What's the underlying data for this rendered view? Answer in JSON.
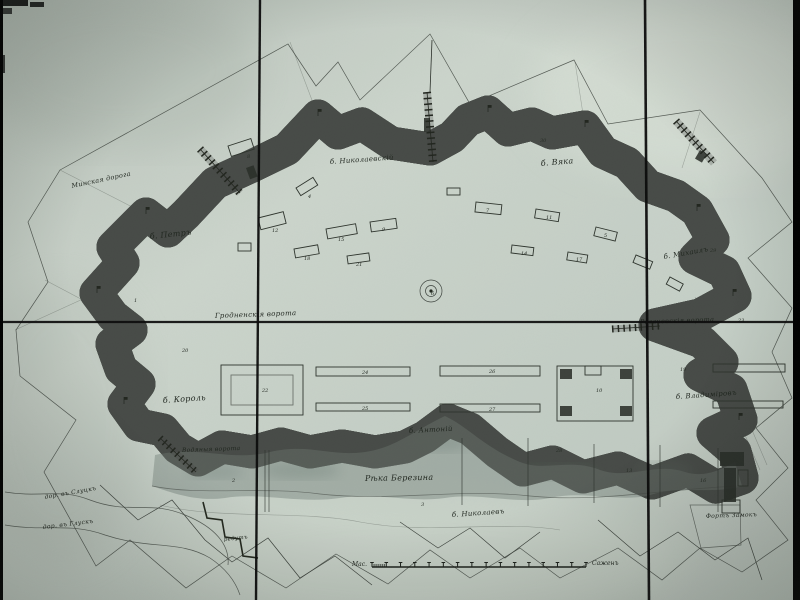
{
  "colors": {
    "paper": "#c6d0c7",
    "paper_light": "#d4dcd2",
    "ink": "#23281f",
    "rampart_dark": "#1e221d",
    "moat_line": "#434843",
    "water": "#94a098",
    "water_deep": "#7c8a83",
    "fold_line": "#0c0c0c",
    "edge_bar": "#000000",
    "label_ink": "#1f251e"
  },
  "plan": {
    "map_labels": [
      {
        "text": "Минская дорога",
        "x": 72,
        "y": 188,
        "rot": -12,
        "size": 6.5
      },
      {
        "text": "б. Петръ",
        "x": 150,
        "y": 239,
        "rot": -6,
        "size": 8
      },
      {
        "text": "б. Николаевскій",
        "x": 330,
        "y": 164,
        "rot": -4,
        "size": 7
      },
      {
        "text": "б. Вяка",
        "x": 541,
        "y": 166,
        "rot": -5,
        "size": 8
      },
      {
        "text": "б. Михаилъ",
        "x": 664,
        "y": 259,
        "rot": -10,
        "size": 7
      },
      {
        "text": "Гродненскія ворота",
        "x": 215,
        "y": 318,
        "rot": -2,
        "size": 7
      },
      {
        "text": "Рогачевскія ворота",
        "x": 640,
        "y": 324,
        "rot": -2,
        "size": 6.5
      },
      {
        "text": "б. Король",
        "x": 163,
        "y": 403,
        "rot": -4,
        "size": 8
      },
      {
        "text": "б. Владиміровъ",
        "x": 676,
        "y": 399,
        "rot": -4,
        "size": 7
      },
      {
        "text": "б. Антоній",
        "x": 409,
        "y": 433,
        "rot": -3,
        "size": 7
      },
      {
        "text": "Рѣка Березина",
        "x": 365,
        "y": 481,
        "rot": -1,
        "size": 8
      },
      {
        "text": "б. Николаевъ",
        "x": 452,
        "y": 517,
        "rot": -4,
        "size": 7
      },
      {
        "text": "Водяныя ворота",
        "x": 182,
        "y": 452,
        "rot": -2,
        "size": 6
      },
      {
        "text": "дор. въ Слуцкъ",
        "x": 45,
        "y": 499,
        "rot": -10,
        "size": 6
      },
      {
        "text": "дор. въ Глускъ",
        "x": 43,
        "y": 529,
        "rot": -7,
        "size": 6
      },
      {
        "text": "Фортъ Замокъ",
        "x": 706,
        "y": 518,
        "rot": -2,
        "size": 6
      },
      {
        "text": "редутъ",
        "x": 224,
        "y": 541,
        "rot": -6,
        "size": 5.5
      }
    ],
    "number_markers": [
      {
        "t": "8",
        "x": 247,
        "y": 158
      },
      {
        "t": "12",
        "x": 272,
        "y": 232
      },
      {
        "t": "4",
        "x": 308,
        "y": 198
      },
      {
        "t": "15",
        "x": 338,
        "y": 241
      },
      {
        "t": "9",
        "x": 382,
        "y": 231
      },
      {
        "t": "18",
        "x": 304,
        "y": 260
      },
      {
        "t": "21",
        "x": 356,
        "y": 266
      },
      {
        "t": "7",
        "x": 486,
        "y": 212
      },
      {
        "t": "11",
        "x": 546,
        "y": 219
      },
      {
        "t": "5",
        "x": 604,
        "y": 237
      },
      {
        "t": "14",
        "x": 521,
        "y": 255
      },
      {
        "t": "17",
        "x": 576,
        "y": 261
      },
      {
        "t": "6",
        "x": 431,
        "y": 295
      },
      {
        "t": "24",
        "x": 362,
        "y": 374
      },
      {
        "t": "26",
        "x": 489,
        "y": 373
      },
      {
        "t": "25",
        "x": 362,
        "y": 410
      },
      {
        "t": "27",
        "x": 489,
        "y": 411
      },
      {
        "t": "22",
        "x": 262,
        "y": 392
      },
      {
        "t": "10",
        "x": 596,
        "y": 392
      },
      {
        "t": "19",
        "x": 680,
        "y": 371
      },
      {
        "t": "2",
        "x": 232,
        "y": 482
      },
      {
        "t": "3",
        "x": 421,
        "y": 506
      },
      {
        "t": "28",
        "x": 556,
        "y": 452
      },
      {
        "t": "13",
        "x": 626,
        "y": 472
      },
      {
        "t": "16",
        "x": 700,
        "y": 482
      },
      {
        "t": "1",
        "x": 134,
        "y": 302
      },
      {
        "t": "20",
        "x": 182,
        "y": 352
      },
      {
        "t": "23",
        "x": 738,
        "y": 322
      },
      {
        "t": "29",
        "x": 710,
        "y": 252
      },
      {
        "t": "30",
        "x": 540,
        "y": 142
      }
    ],
    "scale_bar": {
      "left_label": "Мас.",
      "right_label": "Саженъ",
      "x1": 372,
      "x2": 586,
      "y": 567,
      "major_ticks": 15,
      "minor_ticks": 6
    }
  }
}
